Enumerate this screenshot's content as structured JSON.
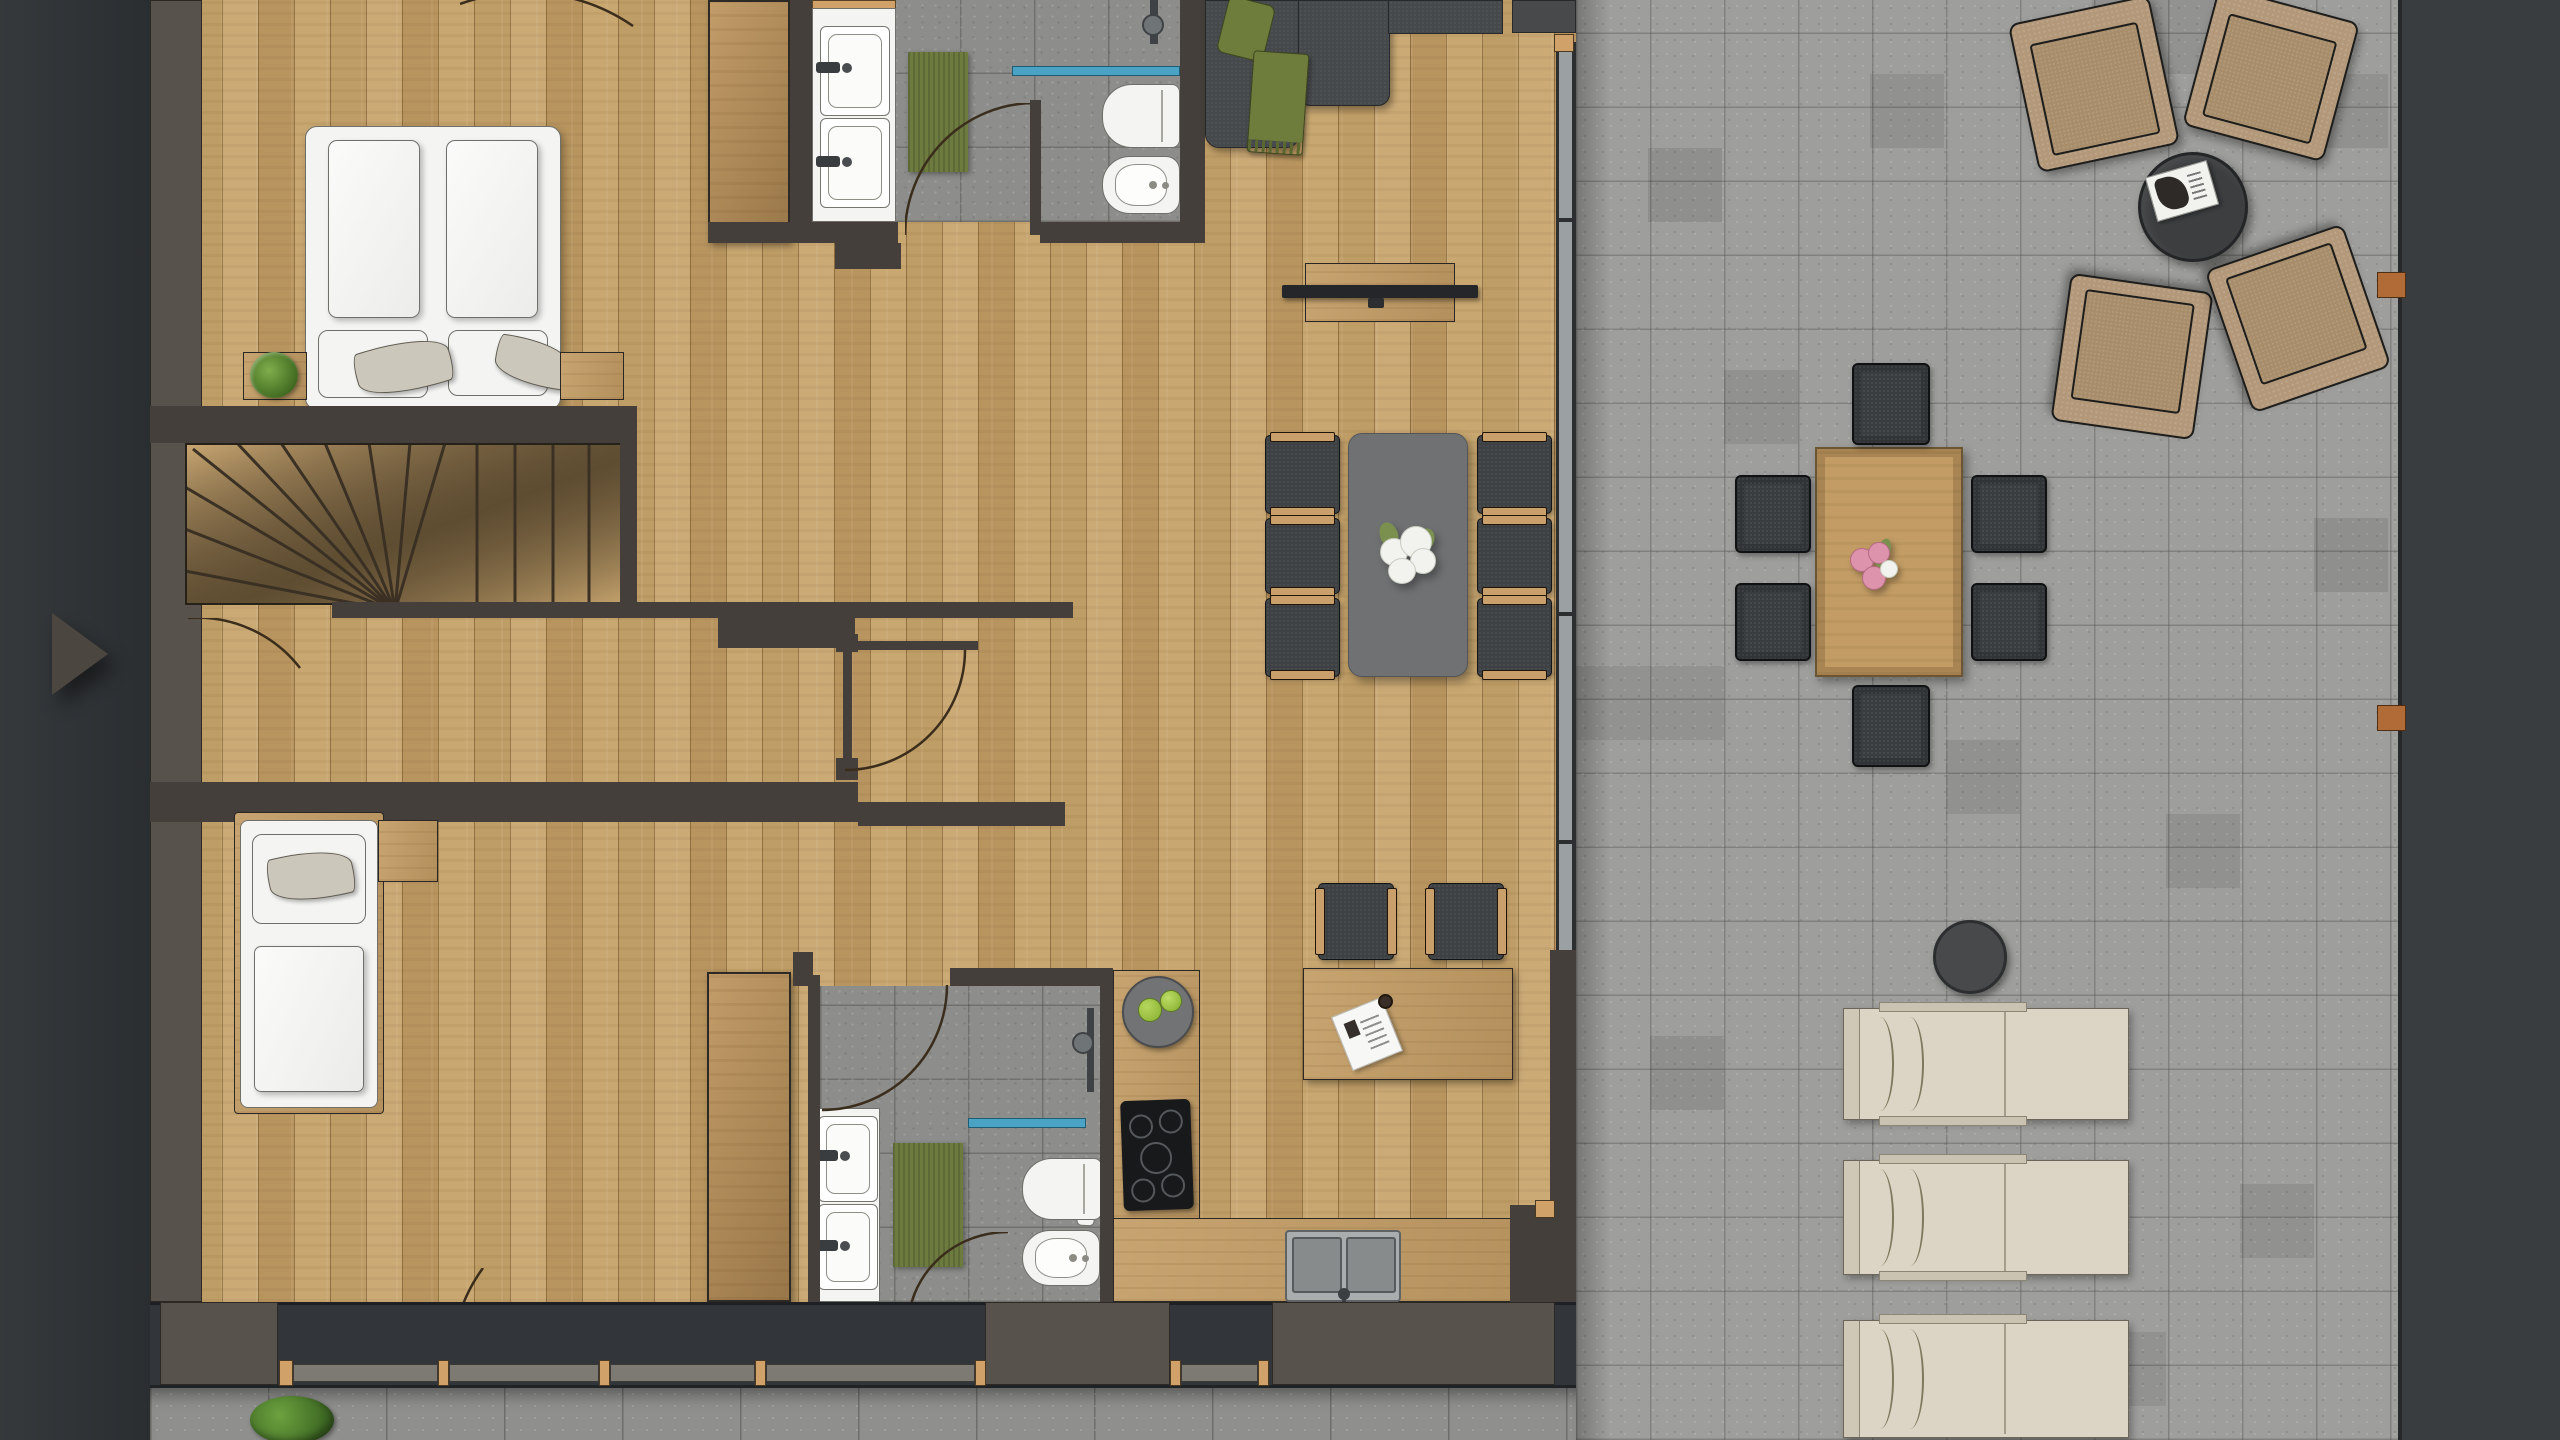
{
  "scene": {
    "kind": "floor-plan-render",
    "view": "top-down",
    "areas": [
      "bedroom-1",
      "bathroom-1",
      "staircase",
      "hallway",
      "bedroom-2",
      "bathroom-2",
      "kitchen",
      "living-dining",
      "desk-nook",
      "patio",
      "walkway"
    ]
  },
  "controls": {
    "next_button": {
      "icon": "play-arrow-icon",
      "direction": "right"
    }
  },
  "palette": {
    "exterior": "#33373a",
    "wall_dark": "#443f3a",
    "wall_light": "#57524b",
    "band_dark": "#32363a",
    "wood_floor": "#c6a26f",
    "wood_counter": "#c29c64",
    "wood_wardrobe": "#bb9158",
    "tile_bath": "#8d8d8b",
    "tile_patio": "#9e9e9c",
    "tile_path": "#8f8f8d",
    "sofa_charcoal": "#46494c",
    "chair_charcoal": "#3e4144",
    "chair_outdoor": "#3a3d3f",
    "chair_wood_trim": "#c9a06b",
    "dining_table_gray": "#6f7173",
    "outdoor_chair_tan": "#b3987a",
    "outdoor_seat_tan": "#a88d6b",
    "lounger_cream": "#dcd5c5",
    "side_table_gray": "#47494b",
    "coffee_table_dark": "#3c3e40",
    "rug_green": "#6d7b3f",
    "pillow_green": "#6f7d3c",
    "shower_glass_blue": "#4aa3c4",
    "fixture_white": "#f4f5f3",
    "plant_green": "#55832f",
    "apple_green": "#95bb3e",
    "wood_clip_brown": "#b06b36",
    "window_frame_gray": "#9ba0a2",
    "window_sill_tan": "#d0a269",
    "arrow_gray": "#4b4640",
    "glass_strip_gray": "#7d7a74",
    "right_band": "#3a3d3f"
  }
}
